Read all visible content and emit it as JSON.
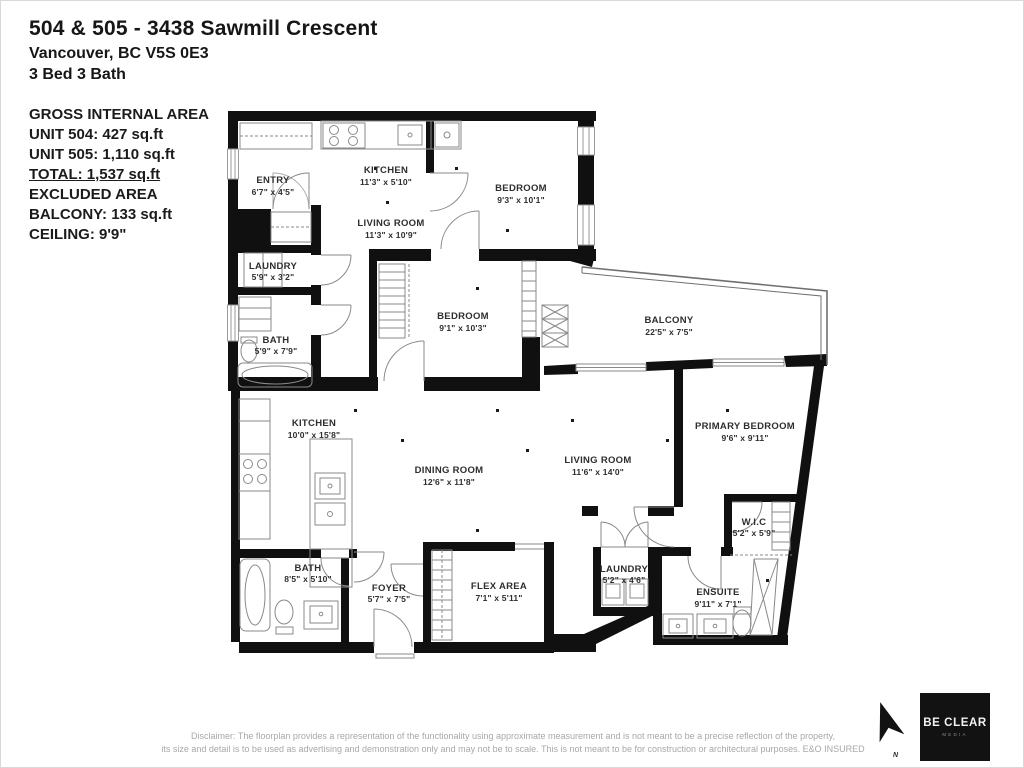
{
  "header": {
    "title": "504 & 505 - 3438 Sawmill Crescent",
    "address": "Vancouver, BC V5S 0E3",
    "beds_baths": "3 Bed 3 Bath"
  },
  "area_summary": {
    "heading": "GROSS INTERNAL AREA",
    "unit504": "UNIT 504: 427 sq.ft",
    "unit505": "UNIT 505: 1,110 sq.ft",
    "total": "TOTAL: 1,537 sq.ft",
    "excluded_heading": "EXCLUDED AREA",
    "balcony": "BALCONY: 133 sq.ft",
    "ceiling": "CEILING: 9'9\""
  },
  "floorplan": {
    "rooms": [
      {
        "name": "ENTRY",
        "dims": "6'7\" x 4'5\""
      },
      {
        "name": "KITCHEN",
        "dims": "11'3\" x 5'10\""
      },
      {
        "name": "LIVING ROOM",
        "dims": "11'3\" x 10'9\""
      },
      {
        "name": "BEDROOM",
        "dims": "9'3\" x 10'1\""
      },
      {
        "name": "LAUNDRY",
        "dims": "5'9\" x 3'2\""
      },
      {
        "name": "BATH",
        "dims": "5'9\" x 7'9\""
      },
      {
        "name": "BEDROOM",
        "dims": "9'1\" x 10'3\""
      },
      {
        "name": "BALCONY",
        "dims": "22'5\" x 7'5\""
      },
      {
        "name": "PRIMARY BEDROOM",
        "dims": "9'6\" x 9'11\""
      },
      {
        "name": "KITCHEN",
        "dims": "10'0\" x 15'8\""
      },
      {
        "name": "DINING ROOM",
        "dims": "12'6\" x 11'8\""
      },
      {
        "name": "LIVING ROOM",
        "dims": "11'6\" x 14'0\""
      },
      {
        "name": "W.I.C",
        "dims": "5'2\" x 5'9\""
      },
      {
        "name": "BATH",
        "dims": "8'5\" x 5'10\""
      },
      {
        "name": "FOYER",
        "dims": "5'7\" x 7'5\""
      },
      {
        "name": "FLEX AREA",
        "dims": "7'1\" x 5'11\""
      },
      {
        "name": "LAUNDRY",
        "dims": "5'2\" x 4'6\""
      },
      {
        "name": "ENSUITE",
        "dims": "9'11\" x 7'1\""
      }
    ]
  },
  "compass": {
    "label": "N"
  },
  "logo": {
    "name": "BE CLEAR",
    "subtext": "MEDIA"
  },
  "disclaimer": {
    "line1": "Disclaimer: The floorplan provides a representation of the functionality using approximate measurement and is not meant to be a precise reflection of the property,",
    "line2": "its size and detail is to be used as advertising and demonstration only and may not be to scale. This is not meant to be for construction or architectural purposes. E&O INSURED"
  }
}
